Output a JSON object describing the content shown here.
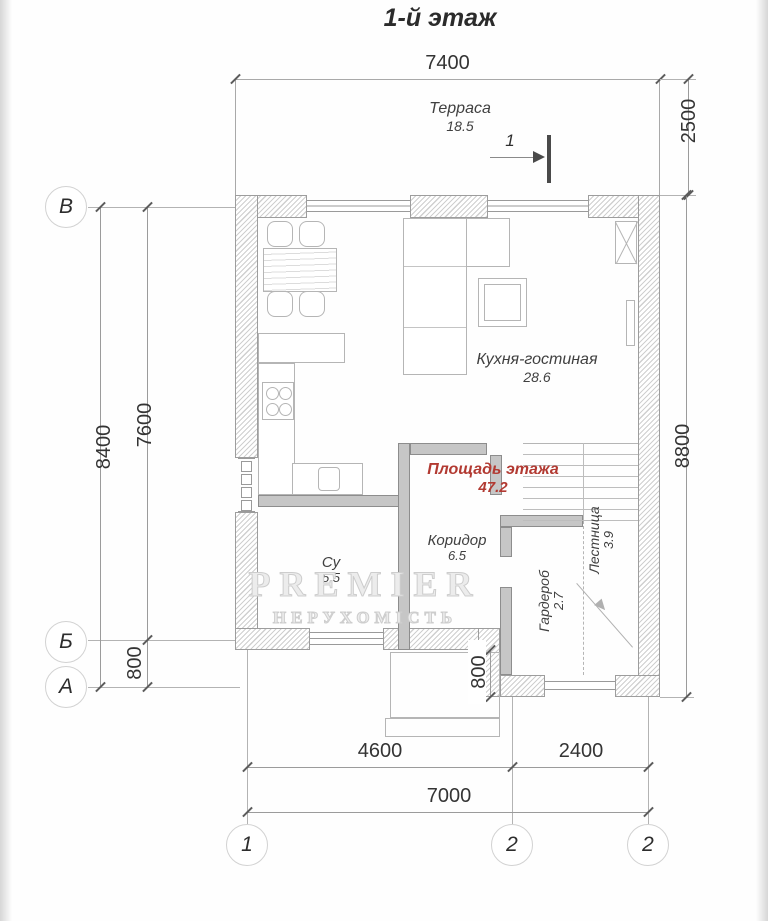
{
  "title": "1-й этаж",
  "axes": {
    "rows": [
      "В",
      "Б",
      "А"
    ],
    "cols": [
      "1",
      "2",
      "2"
    ]
  },
  "dims": {
    "top_width": "7400",
    "terrace_depth": "2500",
    "right_height": "8800",
    "left_total": "8400",
    "left_main": "7600",
    "left_offset": "800",
    "entry_offset": "800",
    "bottom_left": "4600",
    "bottom_right": "2400",
    "bottom_total": "7000"
  },
  "rooms": {
    "terrace": {
      "name": "Терраса",
      "area": "18.5"
    },
    "kitchen": {
      "name": "Кухня-гостиная",
      "area": "28.6"
    },
    "bathroom": {
      "name": "Су",
      "area": "5.5"
    },
    "corridor": {
      "name": "Коридор",
      "area": "6.5"
    },
    "wardrobe": {
      "name": "Гардероб",
      "area": "2.7"
    },
    "stairs": {
      "name": "Лестница",
      "area": "3.9"
    }
  },
  "floor_area": {
    "label": "Площадь этажа",
    "value": "47.2",
    "color": "#b23a32"
  },
  "section_marker": "1",
  "watermark": {
    "line1": "PREMIER",
    "line2": "НЕРУХОМІСТЬ"
  }
}
